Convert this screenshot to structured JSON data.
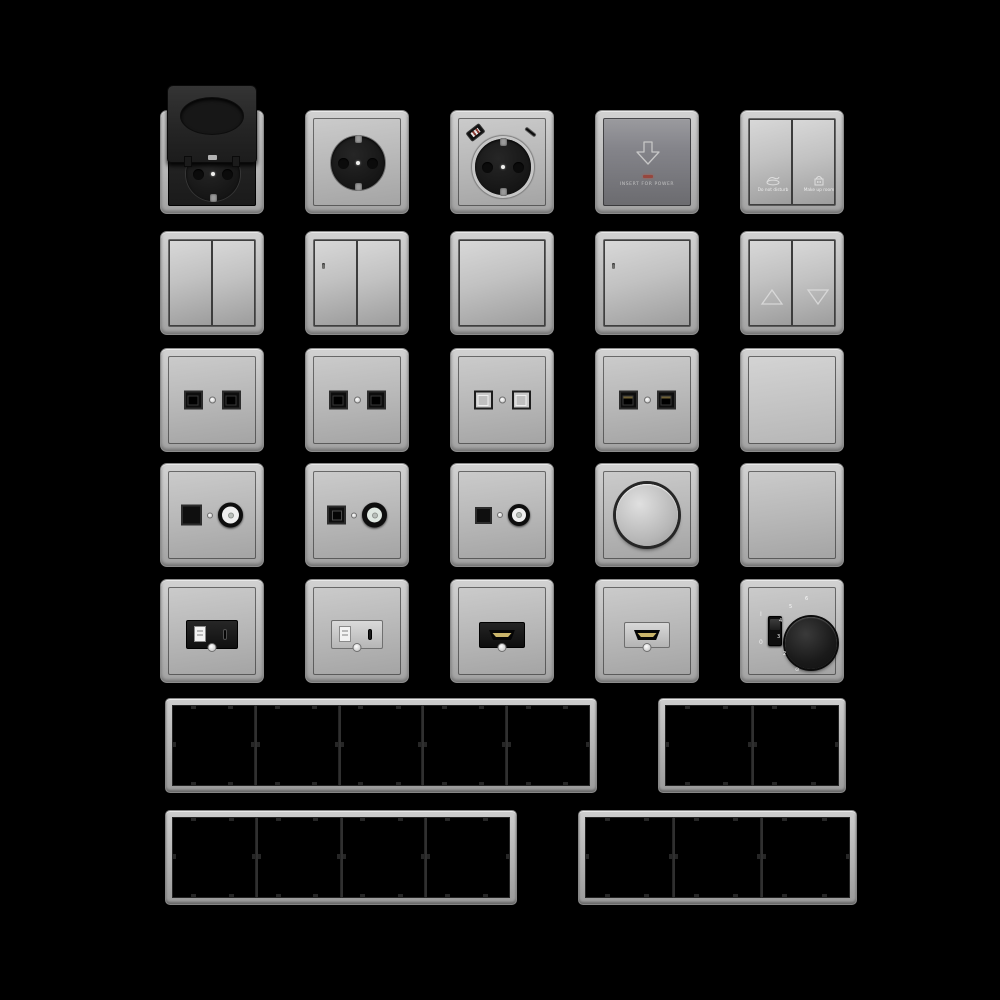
{
  "sheet": {
    "background_color": "#000000",
    "metal_color": "#bdbdbd",
    "module_black_color": "#1c1c1c",
    "led_red_color": "#96473e",
    "hdmi_gold_color": "#c9b46a"
  },
  "items": [
    {
      "name": "socket-flip-lid",
      "type": "socket_flip_lid",
      "row": 0,
      "col": 0
    },
    {
      "name": "socket-schuko",
      "type": "socket_schuko",
      "row": 0,
      "col": 1
    },
    {
      "name": "socket-schuko-usb",
      "type": "socket_schuko_usb",
      "row": 0,
      "col": 2
    },
    {
      "name": "keycard-switch",
      "type": "keycard_switch",
      "row": 0,
      "col": 3,
      "label": "INSERT FOR POWER"
    },
    {
      "name": "hotel-service-rocker",
      "type": "rocker_double_hotel",
      "row": 0,
      "col": 4,
      "left_label": "Do not disturb",
      "right_label": "Make up room"
    },
    {
      "name": "rocker-double",
      "type": "rocker_double",
      "row": 1,
      "col": 0,
      "led": false
    },
    {
      "name": "rocker-double-led",
      "type": "rocker_double",
      "row": 1,
      "col": 1,
      "led": true
    },
    {
      "name": "rocker-single",
      "type": "rocker_single",
      "row": 1,
      "col": 2,
      "led": false
    },
    {
      "name": "rocker-single-led",
      "type": "rocker_single",
      "row": 1,
      "col": 3,
      "led": true
    },
    {
      "name": "rocker-blind",
      "type": "rocker_blind",
      "row": 1,
      "col": 4
    },
    {
      "name": "data-outlet-double-black-1",
      "type": "data_outlet",
      "row": 2,
      "col": 0,
      "variant": "black"
    },
    {
      "name": "data-outlet-double-black-2",
      "type": "data_outlet",
      "row": 2,
      "col": 1,
      "variant": "black"
    },
    {
      "name": "data-outlet-double-light",
      "type": "data_outlet",
      "row": 2,
      "col": 2,
      "variant": "light"
    },
    {
      "name": "data-outlet-double-rj45",
      "type": "data_outlet",
      "row": 2,
      "col": 3,
      "variant": "rj45"
    },
    {
      "name": "blank-plate-raised",
      "type": "blank_raised",
      "row": 2,
      "col": 4
    },
    {
      "name": "tv-data-outlet-1",
      "type": "tv_data",
      "row": 3,
      "col": 0,
      "variant": "a"
    },
    {
      "name": "tv-data-outlet-2",
      "type": "tv_data",
      "row": 3,
      "col": 1,
      "variant": "b"
    },
    {
      "name": "tv-data-outlet-3",
      "type": "tv_data",
      "row": 3,
      "col": 2,
      "variant": "c"
    },
    {
      "name": "rotary-dimmer",
      "type": "dimmer",
      "row": 3,
      "col": 3
    },
    {
      "name": "blank-plate-flat",
      "type": "blank_flat",
      "row": 3,
      "col": 4
    },
    {
      "name": "usb-charger-black",
      "type": "usb_charger",
      "row": 4,
      "col": 0,
      "module": "black"
    },
    {
      "name": "usb-charger-light",
      "type": "usb_charger",
      "row": 4,
      "col": 1,
      "module": "light"
    },
    {
      "name": "hdmi-outlet-black",
      "type": "hdmi_outlet",
      "row": 4,
      "col": 2,
      "module": "black"
    },
    {
      "name": "hdmi-outlet-light",
      "type": "hdmi_outlet",
      "row": 4,
      "col": 3,
      "module": "light"
    },
    {
      "name": "thermostat",
      "type": "thermostat",
      "row": 4,
      "col": 4,
      "slider_on": "I",
      "slider_off": "0",
      "scale": [
        "6",
        "5",
        "4",
        "3",
        "2"
      ],
      "scale_symbol": "⊙"
    }
  ],
  "frames": [
    {
      "name": "frame-5-gang",
      "gangs": 5
    },
    {
      "name": "frame-2-gang",
      "gangs": 2
    },
    {
      "name": "frame-4-gang",
      "gangs": 4
    },
    {
      "name": "frame-3-gang",
      "gangs": 3
    }
  ]
}
